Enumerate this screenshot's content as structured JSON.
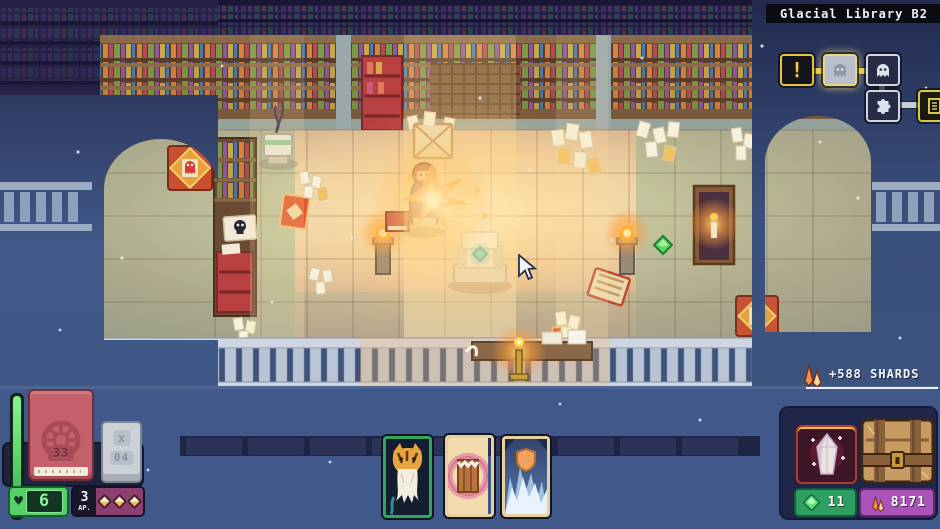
{
  "location": {
    "title": "Glacial Library B2"
  },
  "minimap": {
    "nodes": [
      {
        "icon": "exclamation-icon",
        "state": "current"
      },
      {
        "icon": "ghost-icon",
        "state": "highlighted"
      },
      {
        "icon": "ghost-icon",
        "state": "normal"
      },
      {
        "icon": "puzzle-icon",
        "state": "normal"
      },
      {
        "icon": "door-icon",
        "state": "edge-clipped"
      }
    ],
    "exclamation_glyph": "!",
    "discard_x_glyph": "x"
  },
  "player": {
    "hp": "6",
    "hp_heart_glyph": "♥",
    "ap_value": "3",
    "ap_label": "AP.",
    "ap_pips": 3,
    "deck_count": "33",
    "discard_count": "04"
  },
  "hand": {
    "cards": [
      {
        "name": "beast-card",
        "selected": true
      },
      {
        "name": "bite-card",
        "selected": false
      },
      {
        "name": "ice-shield-card",
        "selected": false
      }
    ]
  },
  "loot_popup": {
    "text": "+588 SHARDS"
  },
  "currencies": {
    "gems": "11",
    "shards": "8171"
  },
  "colors": {
    "accent_yellow": "#e8c43e",
    "hp_green": "#6ee87f",
    "ap_magenta": "#8e3f72",
    "gem_green": "#2f9e63",
    "shard_purple": "#aa54ba",
    "fog_blue": "#3e5780"
  }
}
